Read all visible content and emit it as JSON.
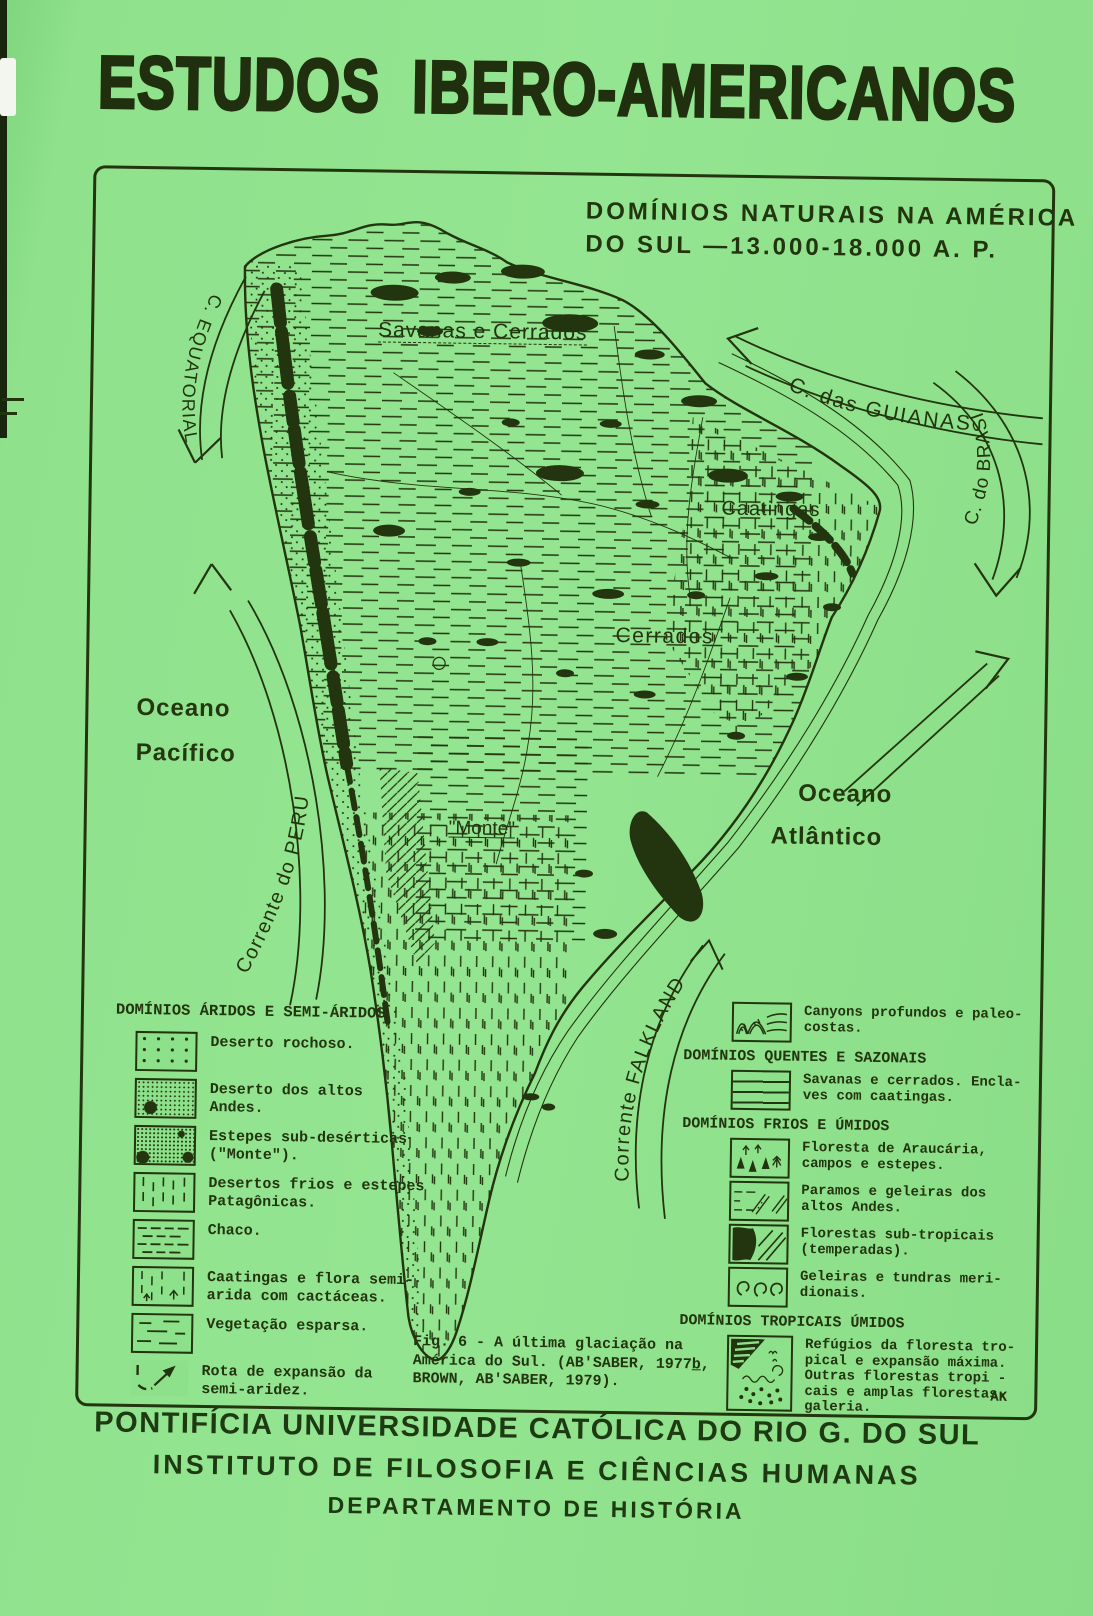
{
  "colors": {
    "paper_green": "#8ee18b",
    "ink": "#22350f"
  },
  "page": {
    "title": "ESTUDOS IBERO-AMERICANOS"
  },
  "figure": {
    "title_line1": "DOMÍNIOS NATURAIS NA AMÉRICA",
    "title_line2": "DO SUL —13.000-18.000 A. P.",
    "signature": "AK",
    "caption_line1": "Fig. 6 - A última glaciação na",
    "caption_line2a": "América do Sul. (AB'SABER, 1977",
    "caption_line2b": "b",
    "caption_line2c": ",",
    "caption_line3": "BROWN, AB'SABER, 1979)."
  },
  "map": {
    "labels": {
      "savanas": "Savanas e  Cerrados",
      "caatingas": "Caatingas",
      "cerrados": "Cerrados",
      "monte": "\"Monte\""
    },
    "oceans": {
      "pacific1": "Oceano",
      "pacific2": "Pacífico",
      "atlantic1": "Oceano",
      "atlantic2": "Atlântico"
    },
    "currents": {
      "equatorial": "C. EQUATORIAL",
      "guianas": "C. das GUIANAS",
      "brasil": "C. do BRASIL",
      "peru": "Corrente do PERU",
      "falkland": "Corrente  FALKLAND"
    }
  },
  "legend_left": {
    "header": "DOMÍNIOS ÁRIDOS E SEMI-ÁRIDOS",
    "items": [
      {
        "symbol": "dots-sparse",
        "label": "Deserto rochoso."
      },
      {
        "symbol": "stipple-dense",
        "label": "Deserto dos altos\nAndes."
      },
      {
        "symbol": "stipple-clumps",
        "label": "Estepes sub-desérticas\n(\"Monte\")."
      },
      {
        "symbol": "vertical-dashes",
        "label": "Desertos frios e estepes\nPatagônicas."
      },
      {
        "symbol": "horizontal-dashes",
        "label": "Chaco."
      },
      {
        "symbol": "caatinga-plants",
        "label": "Caatingas e flora semi-\narida com cactáceas."
      },
      {
        "symbol": "sparse-dashes",
        "label": "Vegetação esparsa."
      },
      {
        "symbol": "expansion-arrow",
        "label": "Rota de expansão da\nsemi-aridez."
      }
    ]
  },
  "legend_right": {
    "canyons": {
      "symbol": "canyons",
      "label": "Canyons profundos e paleo-\ncostas."
    },
    "sections": [
      {
        "header": "DOMÍNIOS QUENTES E SAZONAIS",
        "items": [
          {
            "symbol": "horizontal-lines",
            "label": "Savanas e cerrados. Encla-\nves com caatingas."
          }
        ]
      },
      {
        "header": "DOMÍNIOS FRIOS E ÚMIDOS",
        "items": [
          {
            "symbol": "araucaria-trees",
            "label": "Floresta de Araucária,\ncampos e estepes."
          },
          {
            "symbol": "paramo-glaciers",
            "label": "Paramos e geleiras dos\naltos Andes."
          },
          {
            "symbol": "subtropical-forest",
            "label": "Florestas sub-tropicais\n(temperadas)."
          },
          {
            "symbol": "glacier-swirls",
            "label": "Geleiras e tundras meri-\ndionais."
          }
        ]
      },
      {
        "header": "DOMÍNIOS TROPICAIS ÚMIDOS",
        "items": [
          {
            "symbol": "tropical-forest",
            "label": "Refúgios da floresta tro-\npical e expansão máxima.\nOutras florestas tropi -\ncais e amplas florestas-\ngaleria."
          }
        ]
      }
    ]
  },
  "footer": {
    "line1": "PONTIFÍCIA UNIVERSIDADE CATÓLICA DO RIO G. DO SUL",
    "line2": "INSTITUTO DE FILOSOFIA E CIÊNCIAS HUMANAS",
    "line3": "DEPARTAMENTO DE HISTÓRIA"
  }
}
